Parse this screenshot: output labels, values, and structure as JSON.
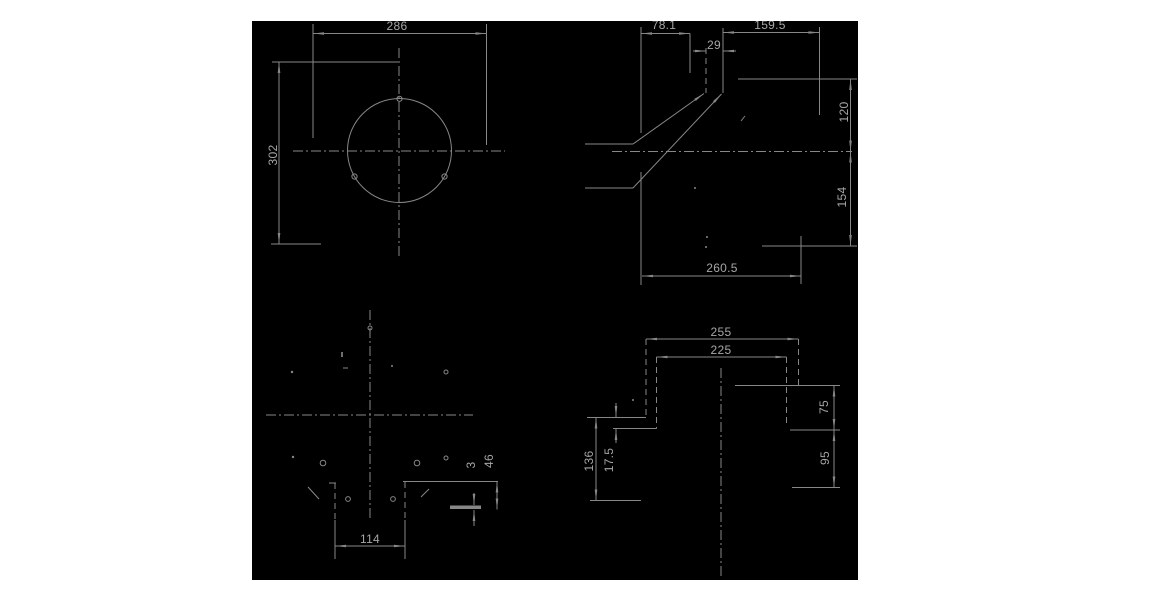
{
  "drawing": {
    "colors": {
      "page_bg": "#ffffff",
      "canvas_bg": "#000000",
      "line": "#878787",
      "text": "#a6a6a6"
    },
    "views": {
      "front_circle": {
        "dims": {
          "width": "286",
          "height": "302"
        }
      },
      "side_profile": {
        "dims": {
          "top_left": "78.1",
          "top_middle": "29",
          "top_right": "159.5",
          "right_upper": "120",
          "right_lower": "154",
          "bottom": "260.5"
        }
      },
      "bottom_detail": {
        "dims": {
          "slot_width": "114",
          "plate_thickness": "3",
          "depth": "46"
        }
      },
      "bracket_front": {
        "dims": {
          "outer_width": "255",
          "inner_width": "225",
          "right_upper": "75",
          "right_lower": "95",
          "left_height": "136",
          "left_offset": "17.5"
        }
      }
    }
  }
}
